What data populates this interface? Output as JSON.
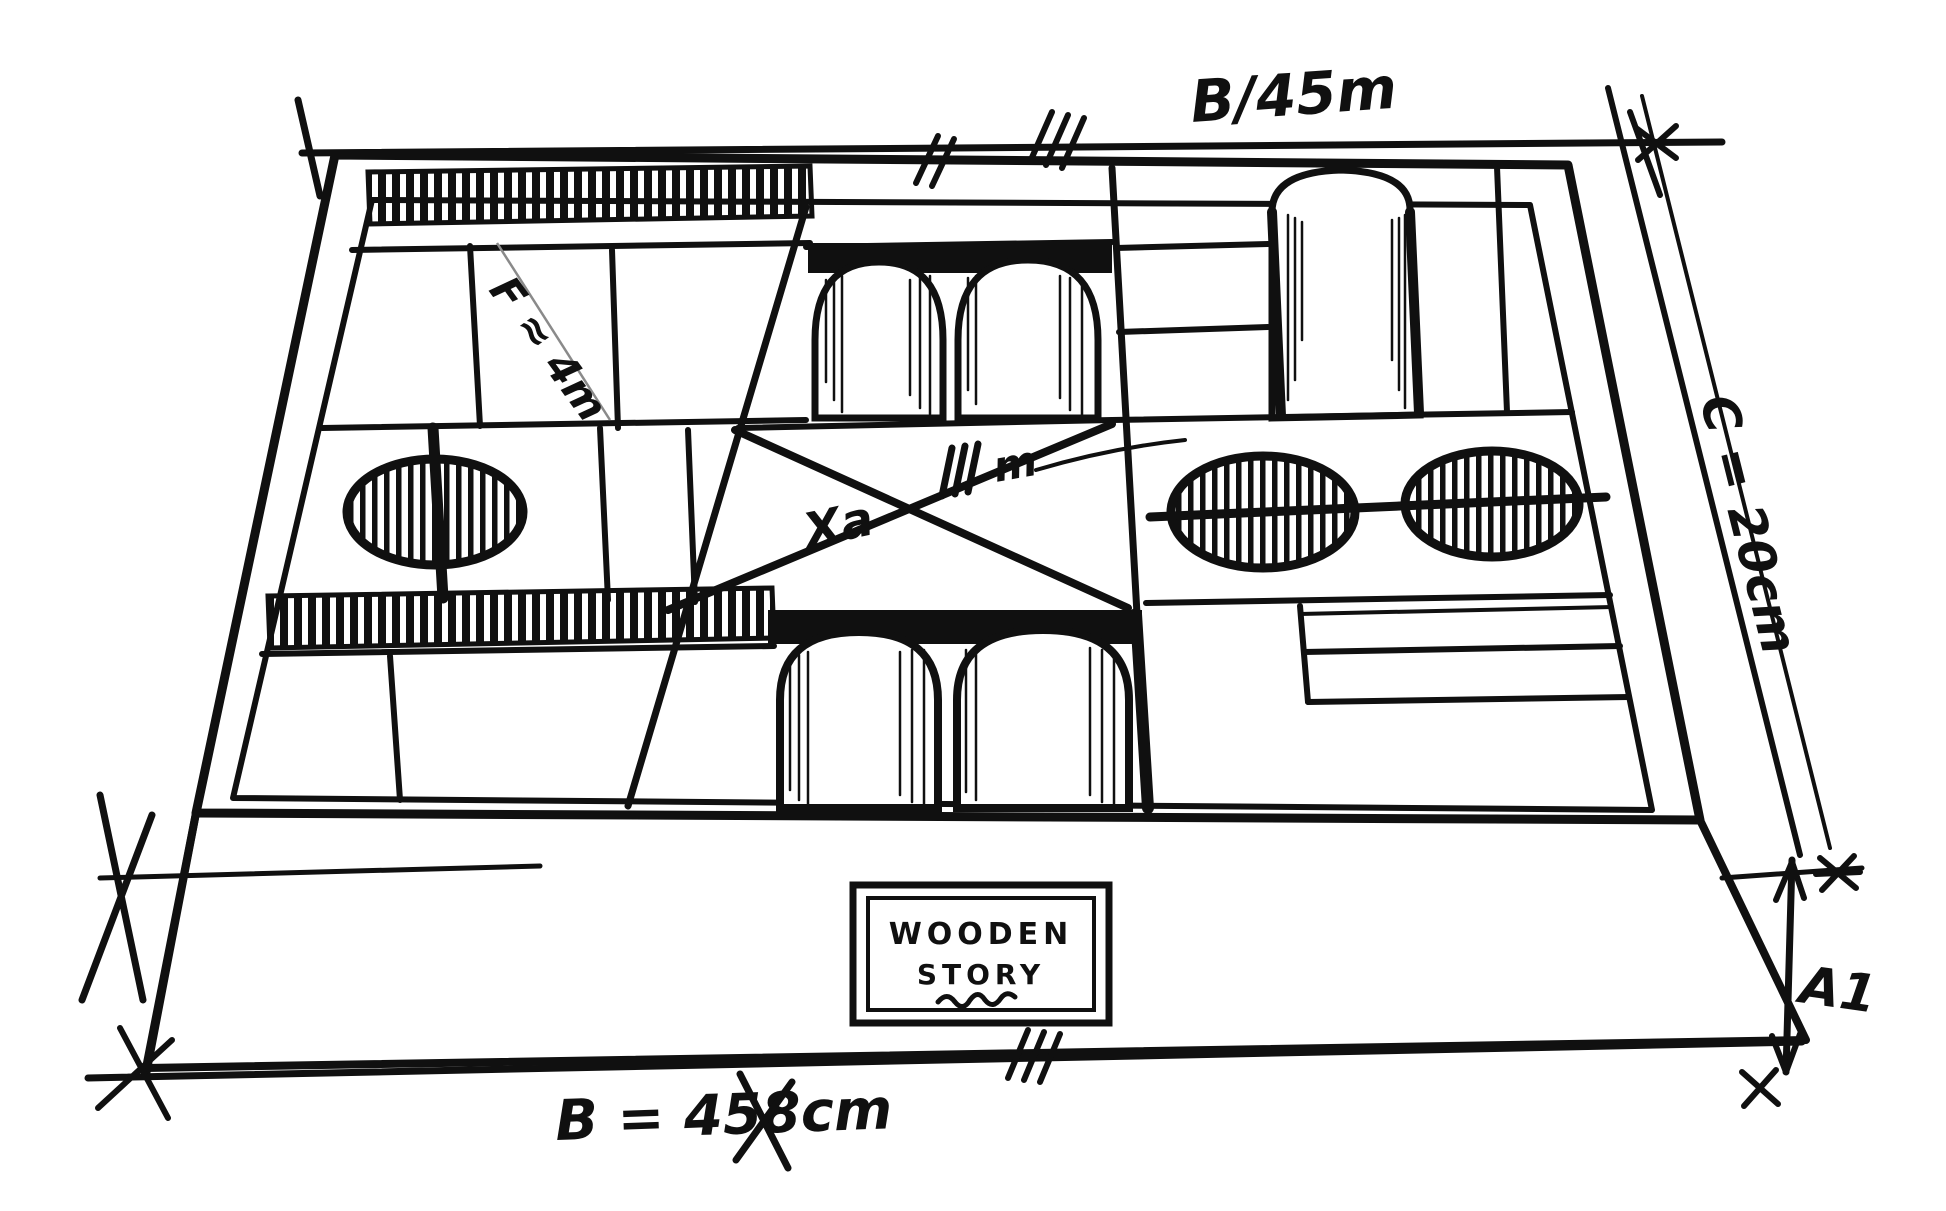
{
  "sketch": {
    "description": "Hand-drawn ink perspective sketch of a wooden blocks storage box with dimension annotations",
    "colors": {
      "ink": "#101010",
      "paper": "#ffffff",
      "pencil": "#8a8a8a"
    },
    "brand": {
      "line1": "WOODEN",
      "line2": "STORY"
    },
    "dimensions": {
      "top_width_label": "B/45m",
      "bottom_width_label": "B = 45",
      "bottom_width_crossed": "8",
      "bottom_width_unit": "cm",
      "side_depth_label": "C = 20cm",
      "front_height_label": "A1",
      "diagonal_detail_label": "F ≈ 4m",
      "center_block_label": "Xa",
      "center_tick_label": "m"
    }
  }
}
